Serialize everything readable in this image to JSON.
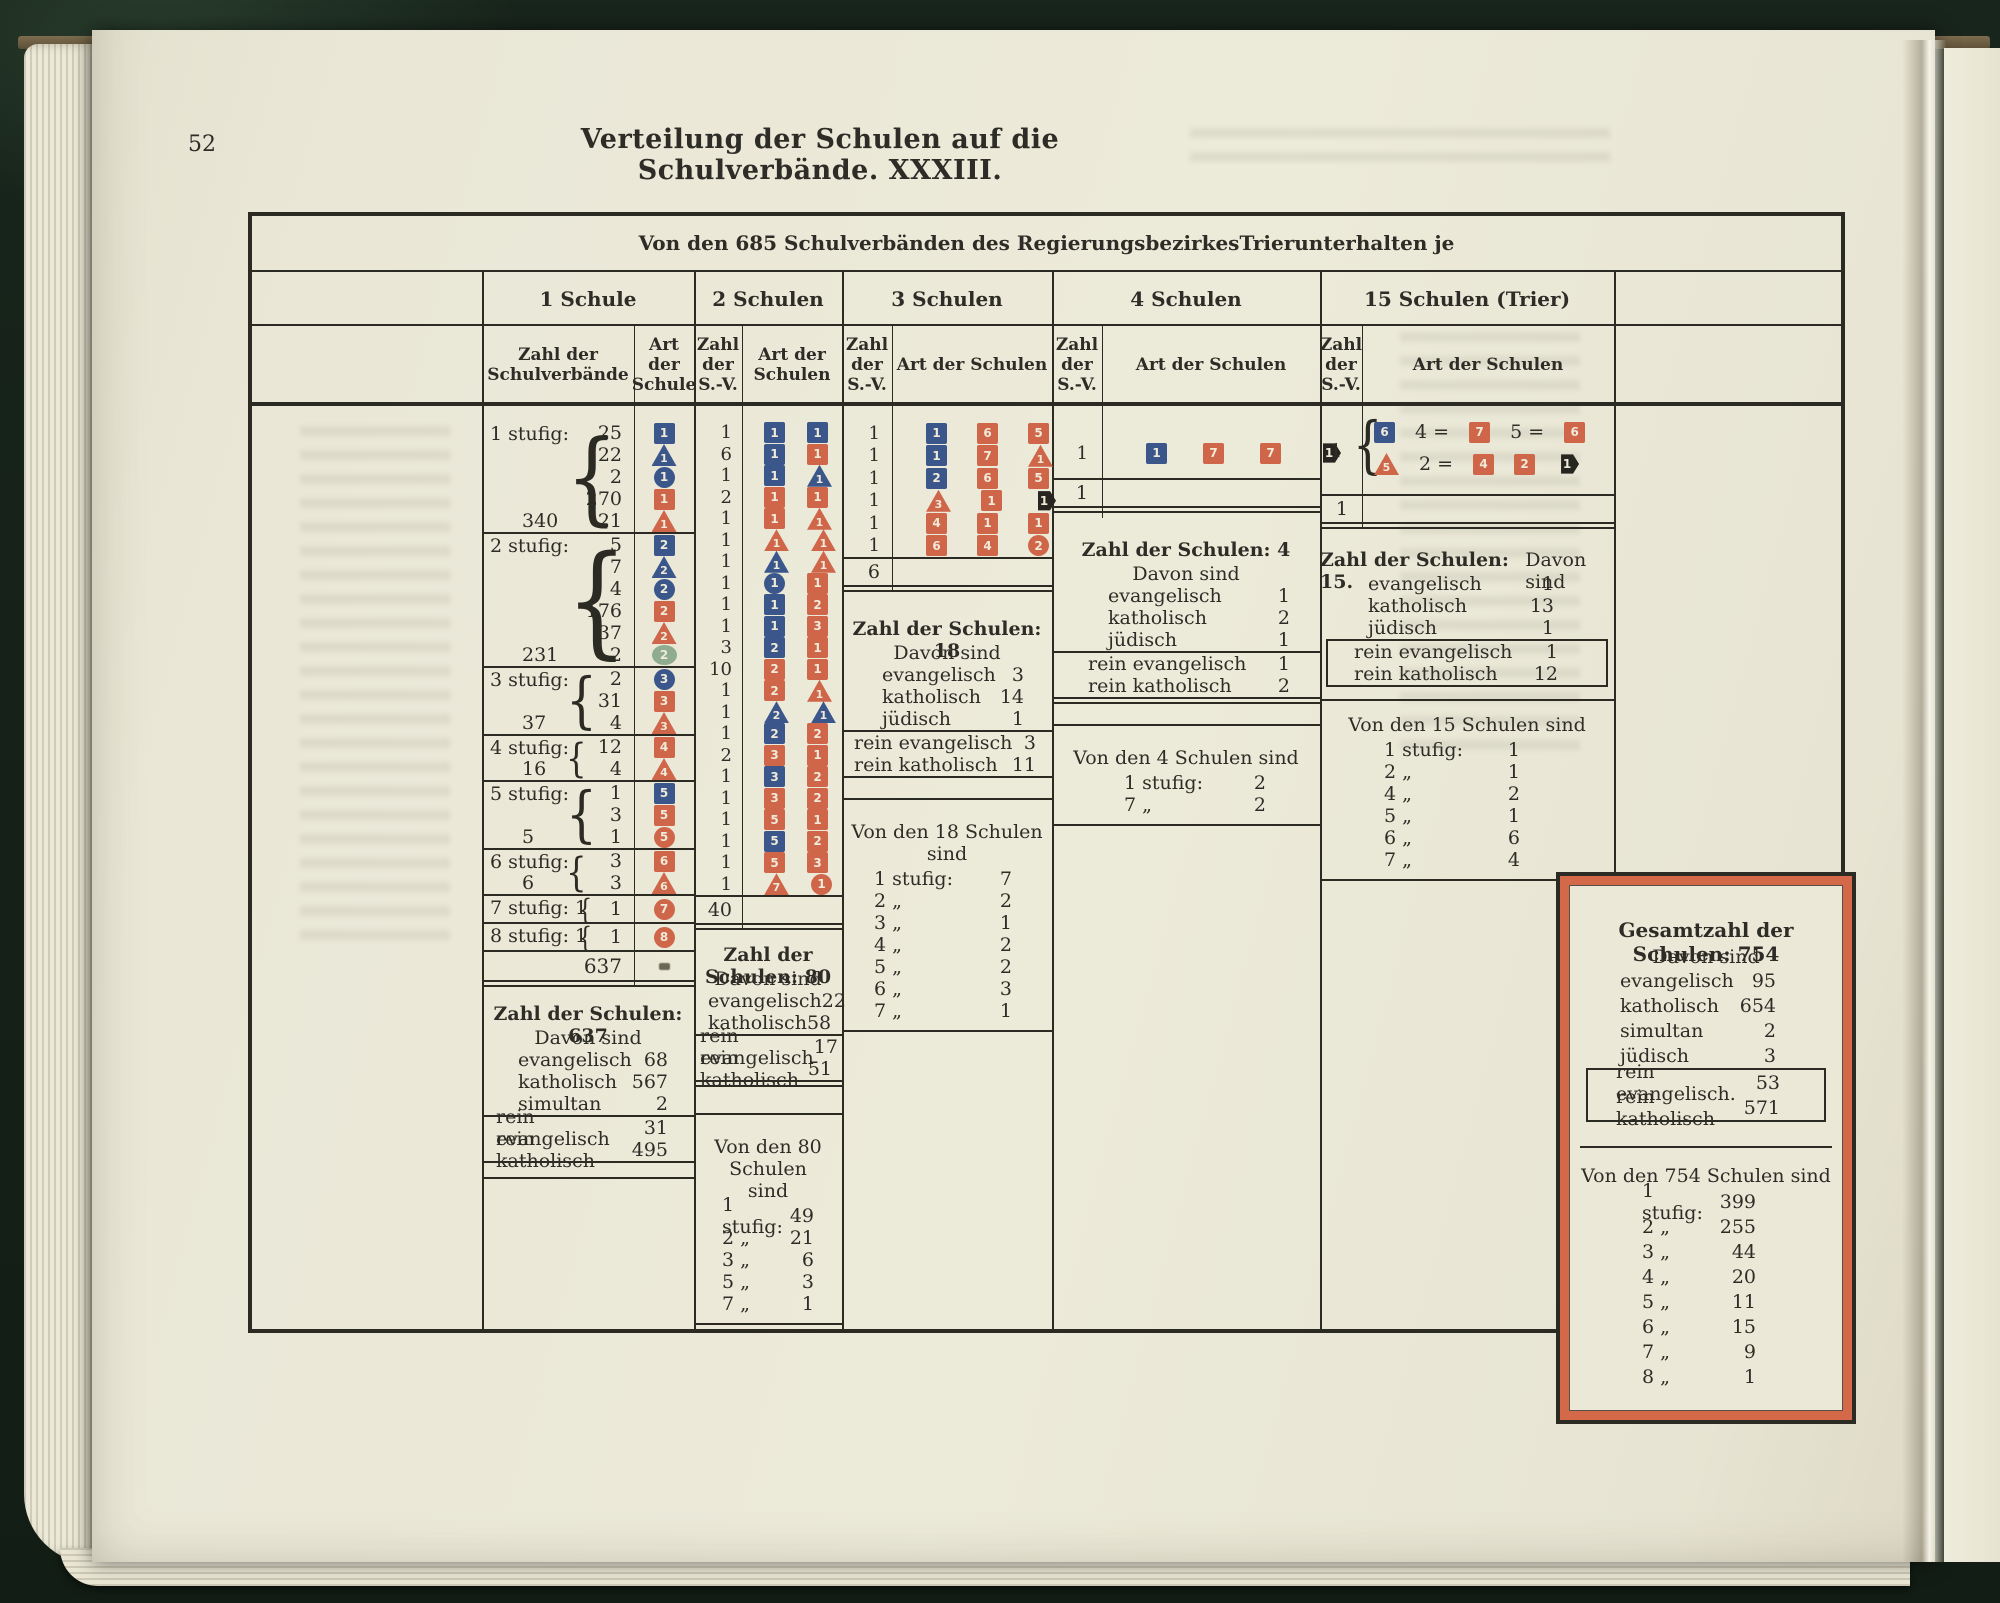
{
  "page": {
    "number": "52",
    "title": "Verteilung der Schulen auf die Schulverbände.  XXXIII."
  },
  "table": {
    "caption_parts": [
      "Von den 685 Schulverbänden des Regierungsbezirkes ",
      "Trier",
      " unterhalten je"
    ],
    "col_headers": [
      "1 Schule",
      "2 Schulen",
      "3 Schulen",
      "4 Schulen",
      "15 Schulen (Trier)"
    ],
    "sub_headers": [
      "Zahl der\nSchulverbände",
      "Art\nder\nSchule",
      "Zahl\nder\nS.-V.",
      "Art der\nSchulen",
      "Zahl\nder\nS.-V.",
      "Art der Schulen",
      "Zahl\nder\nS.-V.",
      "Art der Schulen",
      "Zahl\nder\nS.-V.",
      "Art der Schulen"
    ]
  },
  "legend_colors": {
    "evangelisch_blue": "#3a568b",
    "katholisch_red": "#cf6549",
    "simultan_green": "#8fac90",
    "juedisch_black": "#26251f",
    "paper": "#eae7d8",
    "ink": "#2e2c26",
    "box_border_orange": "#d4694a"
  },
  "col1": {
    "groups": [
      {
        "label": "1 stufig:",
        "total": "340",
        "rows": [
          [
            "25",
            "sq-blue-1"
          ],
          [
            "22",
            "tri-blue-1"
          ],
          [
            "2",
            "cir-blue-1"
          ],
          [
            "270",
            "sq-red-1"
          ],
          [
            "21",
            "tri-red-1"
          ]
        ]
      },
      {
        "label": "2 stufig:",
        "total": "231",
        "rows": [
          [
            "5",
            "sq-blue-2"
          ],
          [
            "7",
            "tri-blue-2"
          ],
          [
            "4",
            "cir-blue-2"
          ],
          [
            "176",
            "sq-red-2"
          ],
          [
            "37",
            "tri-red-2"
          ],
          [
            "2",
            "ell-green-2"
          ]
        ]
      },
      {
        "label": "3 stufig:",
        "total": "37",
        "rows": [
          [
            "2",
            "cir-blue-3"
          ],
          [
            "31",
            "sq-red-3"
          ],
          [
            "4",
            "tri-red-3"
          ]
        ]
      },
      {
        "label": "4 stufig:",
        "total": "16",
        "rows": [
          [
            "12",
            "sq-red-4"
          ],
          [
            "4",
            "tri-red-4"
          ]
        ]
      },
      {
        "label": "5 stufig:",
        "total": "5",
        "rows": [
          [
            "1",
            "sq-blue-5"
          ],
          [
            "3",
            "sq-red-5"
          ],
          [
            "1",
            "cir-red-5"
          ]
        ]
      },
      {
        "label": "6 stufig:",
        "total": "6",
        "rows": [
          [
            "3",
            "sq-red-6"
          ],
          [
            "3",
            "tri-red-6"
          ]
        ]
      },
      {
        "label": "7 stufig: 1",
        "total": "",
        "rows": [
          [
            "1",
            "cir-red-7"
          ]
        ]
      },
      {
        "label": "8 stufig: 1",
        "total": "",
        "rows": [
          [
            "1",
            "cir-red-8"
          ]
        ]
      }
    ],
    "grand_total": "637",
    "summary": {
      "title": "Zahl der Schulen: 637",
      "subtitle": "Davon sind",
      "rows": [
        [
          "evangelisch",
          "68"
        ],
        [
          "katholisch",
          "567"
        ],
        [
          "simultan",
          "2"
        ]
      ],
      "rein": [
        [
          "rein evangelisch",
          "31"
        ],
        [
          "rein katholisch",
          "495"
        ]
      ]
    }
  },
  "col2": {
    "rows": [
      [
        "1",
        [
          "sq-blue-1",
          "sq-blue-1"
        ]
      ],
      [
        "6",
        [
          "sq-blue-1",
          "sq-red-1"
        ]
      ],
      [
        "1",
        [
          "sq-blue-1",
          "tri-blue-1"
        ]
      ],
      [
        "2",
        [
          "sq-red-1",
          "sq-red-1"
        ]
      ],
      [
        "1",
        [
          "sq-red-1",
          "tri-red-1"
        ]
      ],
      [
        "1",
        [
          "tri-red-1",
          "tri-red-1"
        ]
      ],
      [
        "1",
        [
          "tri-blue-1",
          "tri-red-1"
        ]
      ],
      [
        "1",
        [
          "cir-blue-1",
          "sq-red-1"
        ]
      ],
      [
        "1",
        [
          "sq-blue-1",
          "sq-red-2"
        ]
      ],
      [
        "1",
        [
          "sq-blue-1",
          "sq-red-3"
        ]
      ],
      [
        "3",
        [
          "sq-blue-2",
          "sq-red-1"
        ]
      ],
      [
        "10",
        [
          "sq-red-2",
          "sq-red-1"
        ]
      ],
      [
        "1",
        [
          "sq-red-2",
          "tri-red-1"
        ]
      ],
      [
        "1",
        [
          "tri-blue-2",
          "tri-blue-1"
        ]
      ],
      [
        "1",
        [
          "sq-blue-2",
          "sq-red-2"
        ]
      ],
      [
        "2",
        [
          "sq-red-3",
          "sq-red-1"
        ]
      ],
      [
        "1",
        [
          "sq-blue-3",
          "sq-red-2"
        ]
      ],
      [
        "1",
        [
          "sq-red-3",
          "sq-red-2"
        ]
      ],
      [
        "1",
        [
          "sq-red-5",
          "sq-red-1"
        ]
      ],
      [
        "1",
        [
          "sq-blue-5",
          "sq-red-2"
        ]
      ],
      [
        "1",
        [
          "sq-red-5",
          "sq-red-3"
        ]
      ],
      [
        "1",
        [
          "tri-red-7",
          "cir-red-1"
        ]
      ]
    ],
    "total": "40",
    "summary": {
      "title": "Zahl der Schulen: 80",
      "subtitle": "Davon sind",
      "rows": [
        [
          "evangelisch",
          "22"
        ],
        [
          "katholisch",
          "58"
        ]
      ],
      "rein": [
        [
          "rein evangelisch",
          "17"
        ],
        [
          "rein katholisch",
          "51"
        ]
      ]
    },
    "stufig": {
      "title": "Von den 80 Schulen\nsind",
      "rows": [
        [
          "1 stufig:",
          "49"
        ],
        [
          "2  „",
          "21"
        ],
        [
          "3  „",
          "6"
        ],
        [
          "5  „",
          "3"
        ],
        [
          "7  „",
          "1"
        ]
      ]
    }
  },
  "col3": {
    "rows": [
      [
        "1",
        [
          "sq-blue-1",
          "sq-red-6",
          "sq-red-5"
        ]
      ],
      [
        "1",
        [
          "sq-blue-1",
          "sq-red-7",
          "tri-red-1"
        ]
      ],
      [
        "1",
        [
          "sq-blue-2",
          "sq-red-6",
          "sq-red-5"
        ]
      ],
      [
        "1",
        [
          "tri-red-3",
          "sq-red-1",
          "hex-black-1"
        ]
      ],
      [
        "1",
        [
          "sq-red-4",
          "sq-red-1",
          "sq-red-1"
        ]
      ],
      [
        "1",
        [
          "sq-red-6",
          "sq-red-4",
          "cir-red-2"
        ]
      ]
    ],
    "total": "6",
    "summary": {
      "title": "Zahl der Schulen: 18",
      "subtitle": "Davon sind",
      "rows": [
        [
          "evangelisch",
          "3"
        ],
        [
          "katholisch",
          "14"
        ],
        [
          "jüdisch",
          "1"
        ]
      ],
      "rein": [
        [
          "rein evangelisch",
          "3"
        ],
        [
          "rein katholisch",
          "11"
        ]
      ]
    },
    "stufig": {
      "title": "Von den 18 Schulen sind",
      "rows": [
        [
          "1 stufig:",
          "7"
        ],
        [
          "2  „",
          "2"
        ],
        [
          "3  „",
          "1"
        ],
        [
          "4  „",
          "2"
        ],
        [
          "5  „",
          "2"
        ],
        [
          "6  „",
          "3"
        ],
        [
          "7  „",
          "1"
        ]
      ]
    }
  },
  "col4": {
    "rows": [
      [
        "1",
        [
          "sq-blue-1",
          "sq-red-7",
          "sq-red-7",
          "hex-black-1"
        ]
      ]
    ],
    "total": "1",
    "summary": {
      "title": "Zahl der Schulen: 4",
      "subtitle": "Davon sind",
      "rows": [
        [
          "evangelisch",
          "1"
        ],
        [
          "katholisch",
          "2"
        ],
        [
          "jüdisch",
          "1"
        ]
      ],
      "rein": [
        [
          "rein evangelisch",
          "1"
        ],
        [
          "rein katholisch",
          "2"
        ]
      ]
    },
    "stufig": {
      "title": "Von den 4 Schulen sind",
      "rows": [
        [
          "1 stufig:",
          "2"
        ],
        [
          "7  „",
          "2"
        ]
      ]
    }
  },
  "col5": {
    "count": "1",
    "line1": [
      "sym:sq-blue-6",
      "txt:4 =",
      "sym:sq-red-7",
      "txt:5 =",
      "sym:sq-red-6"
    ],
    "line2": [
      "sym:tri-red-5",
      "txt:2 =",
      "sym:sq-red-4",
      "sym:sq-red-2",
      "sym:hex-black-1"
    ],
    "total": "1",
    "summary": {
      "title": "Zahl der Schulen: 15.",
      "subtitle": "Davon sind",
      "rows": [
        [
          "evangelisch",
          "1"
        ],
        [
          "katholisch",
          "13"
        ],
        [
          "jüdisch",
          "1"
        ]
      ],
      "rein": [
        [
          "rein evangelisch",
          "1"
        ],
        [
          "rein katholisch",
          "12"
        ]
      ]
    },
    "stufig": {
      "title": "Von den 15 Schulen sind",
      "rows": [
        [
          "1 stufig:",
          "1"
        ],
        [
          "2  „",
          "1"
        ],
        [
          "4  „",
          "2"
        ],
        [
          "5  „",
          "1"
        ],
        [
          "6  „",
          "6"
        ],
        [
          "7  „",
          "4"
        ]
      ]
    }
  },
  "gesamt": {
    "summary": {
      "title": "Gesamtzahl der Schulen: 754",
      "subtitle": "Davon sind",
      "rows": [
        [
          "evangelisch",
          "95"
        ],
        [
          "katholisch",
          "654"
        ],
        [
          "simultan",
          "2"
        ],
        [
          "jüdisch",
          "3"
        ]
      ],
      "rein": [
        [
          "rein evangelisch.",
          "53"
        ],
        [
          "rein katholisch",
          "571"
        ]
      ]
    },
    "stufig": {
      "title": "Von den 754 Schulen sind",
      "rows": [
        [
          "1 stufig:",
          "399"
        ],
        [
          "2  „",
          "255"
        ],
        [
          "3  „",
          "44"
        ],
        [
          "4  „",
          "20"
        ],
        [
          "5  „",
          "11"
        ],
        [
          "6  „",
          "15"
        ],
        [
          "7  „",
          "9"
        ],
        [
          "8  „",
          "1"
        ]
      ]
    }
  }
}
